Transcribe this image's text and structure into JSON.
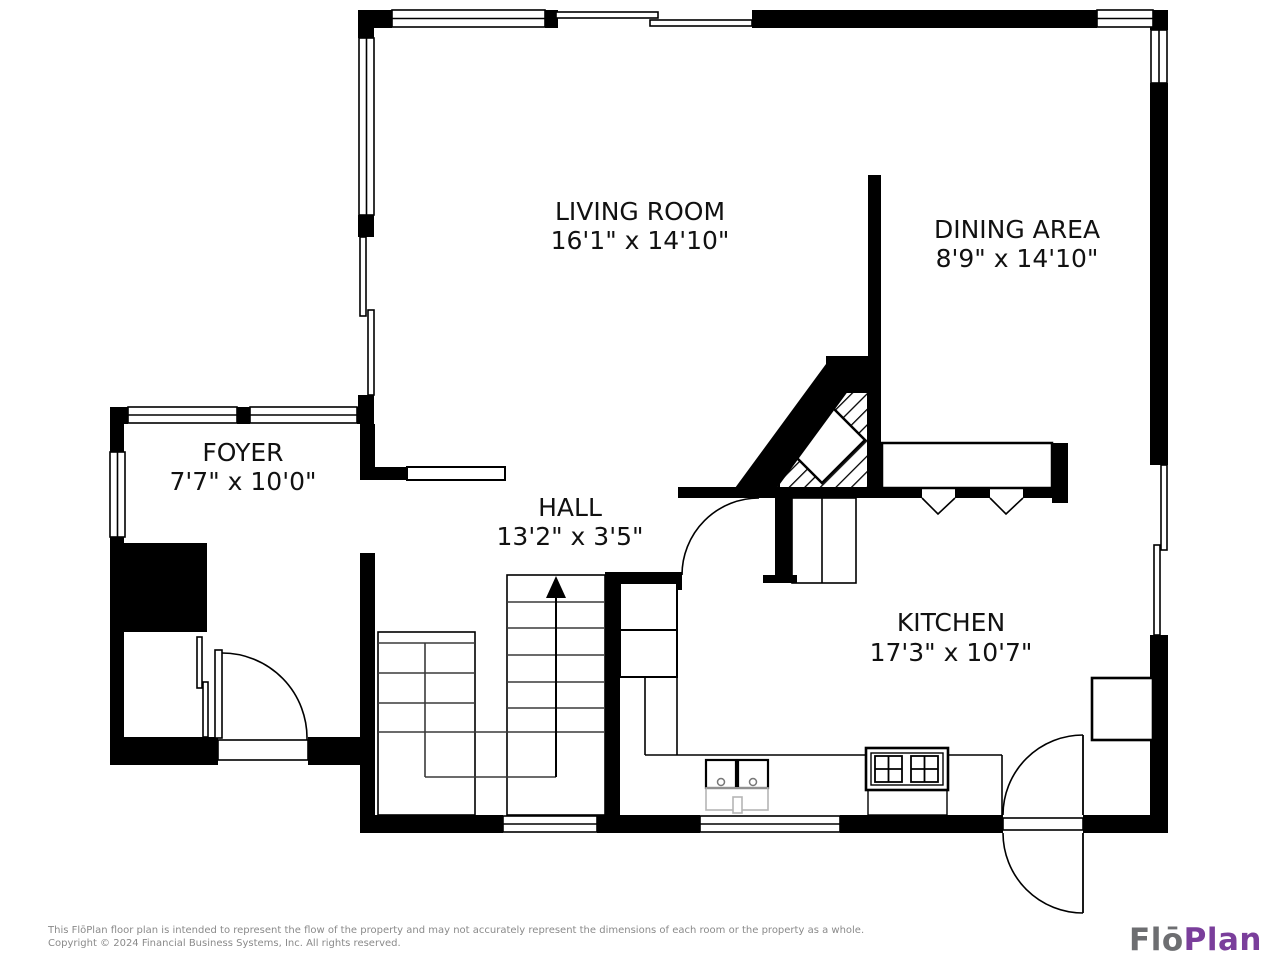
{
  "plan": {
    "rooms": [
      {
        "name": "LIVING ROOM",
        "dims": "16'1\" x 14'10\""
      },
      {
        "name": "DINING AREA",
        "dims": "8'9\" x 14'10\""
      },
      {
        "name": "FOYER",
        "dims": "7'7\" x 10'0\""
      },
      {
        "name": "HALL",
        "dims": "13'2\" x 3'5\""
      },
      {
        "name": "KITCHEN",
        "dims": "17'3\" x 10'7\""
      }
    ],
    "stair_direction": "up"
  },
  "footer": {
    "disclaimer": "This FlōPlan floor plan is intended to represent the flow of the property and may not accurately represent the dimensions of each room or the property as a whole.",
    "copyright": "Copyright © 2024 Financial Business Systems, Inc. All rights reserved."
  },
  "logo": {
    "part1": "Flō",
    "part2": "Plan"
  },
  "colors": {
    "walls": "#000000",
    "room_text": "#111111",
    "footer_text": "#8a8a8a",
    "logo_gray": "#6d6e71",
    "logo_purple": "#7a3e9b"
  }
}
